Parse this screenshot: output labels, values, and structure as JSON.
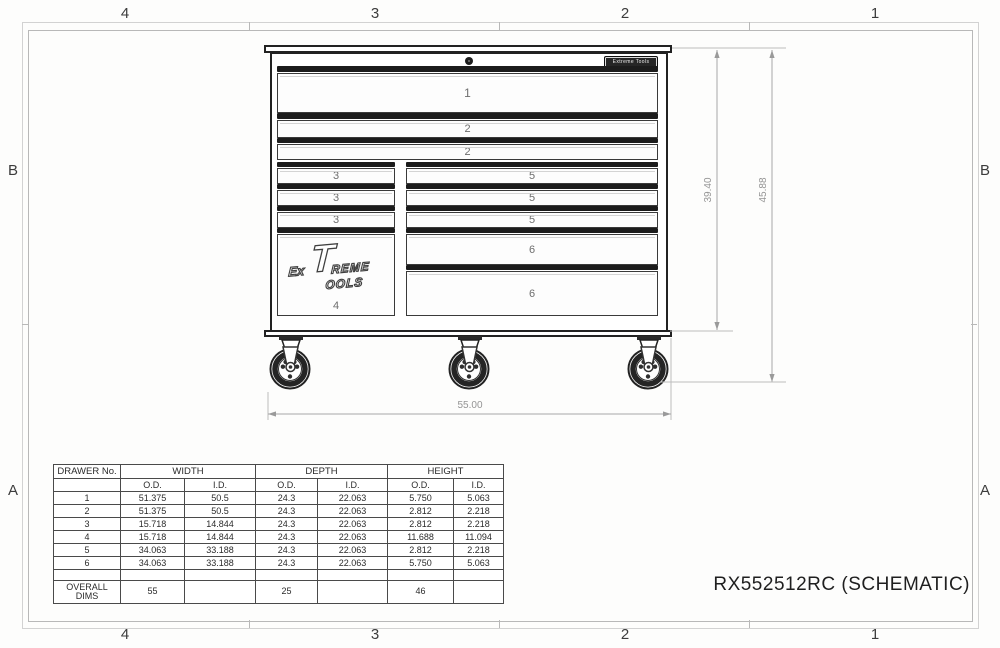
{
  "sheet": {
    "zones_top": [
      "4",
      "3",
      "2",
      "1"
    ],
    "zones_bottom": [
      "4",
      "3",
      "2",
      "1"
    ],
    "zones_left": [
      "B",
      "A"
    ],
    "zones_right": [
      "B",
      "A"
    ],
    "title": "RX552512RC (SCHEMATIC)"
  },
  "cabinet": {
    "badge_text": "Extreme Tools",
    "logo": {
      "ex": "Ex",
      "t": "T",
      "reme": "REME",
      "ools": "OOLS"
    },
    "drawers_full": [
      "1",
      "2",
      "2"
    ],
    "drawers_left": [
      "3",
      "3",
      "3"
    ],
    "drawer_four": "4",
    "drawers_right_small": [
      "5",
      "5",
      "5"
    ],
    "drawers_right_large": [
      "6",
      "6"
    ]
  },
  "dimensions": {
    "width_label": "55.00",
    "body_height_label": "39.40",
    "overall_height_label": "45.88"
  },
  "table": {
    "corner_header": "DRAWER No.",
    "group_headers": [
      "WIDTH",
      "DEPTH",
      "HEIGHT"
    ],
    "sub_headers": [
      "O.D.",
      "I.D.",
      "O.D.",
      "I.D.",
      "O.D.",
      "I.D."
    ],
    "rows": [
      [
        "1",
        "51.375",
        "50.5",
        "24.3",
        "22.063",
        "5.750",
        "5.063"
      ],
      [
        "2",
        "51.375",
        "50.5",
        "24.3",
        "22.063",
        "2.812",
        "2.218"
      ],
      [
        "3",
        "15.718",
        "14.844",
        "24.3",
        "22.063",
        "2.812",
        "2.218"
      ],
      [
        "4",
        "15.718",
        "14.844",
        "24.3",
        "22.063",
        "11.688",
        "11.094"
      ],
      [
        "5",
        "34.063",
        "33.188",
        "24.3",
        "22.063",
        "2.812",
        "2.218"
      ],
      [
        "6",
        "34.063",
        "33.188",
        "24.3",
        "22.063",
        "5.750",
        "5.063"
      ]
    ],
    "overall_label": "OVERALL DIMS",
    "overall_values": [
      "55",
      "",
      "25",
      "",
      "46",
      ""
    ],
    "col_widths": [
      67,
      64,
      71,
      62,
      70,
      66,
      50
    ]
  },
  "colors": {
    "cabinet_line": "#222222",
    "dim_line": "#a8a8a8",
    "dim_text": "#949494",
    "frame": "#b8b8b8"
  }
}
